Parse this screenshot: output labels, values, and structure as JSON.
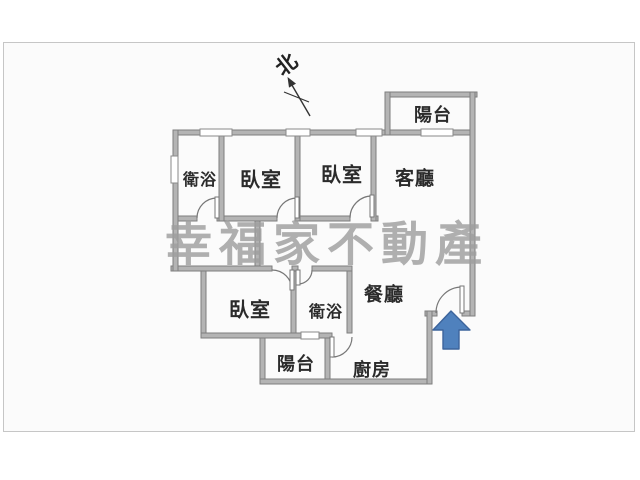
{
  "compass": {
    "label": "北"
  },
  "watermark": {
    "text": "幸福家不動產",
    "color": "#9e9e9e"
  },
  "rooms": [
    {
      "id": "bathroom-top",
      "label": "衛浴"
    },
    {
      "id": "bedroom-top-left",
      "label": "臥室"
    },
    {
      "id": "bedroom-top-middle",
      "label": "臥室"
    },
    {
      "id": "living-room",
      "label": "客廳"
    },
    {
      "id": "balcony-top",
      "label": "陽台"
    },
    {
      "id": "dining-room",
      "label": "餐廳"
    },
    {
      "id": "bedroom-lower",
      "label": "臥室"
    },
    {
      "id": "bathroom-lower",
      "label": "衛浴"
    },
    {
      "id": "balcony-bottom",
      "label": "陽台"
    },
    {
      "id": "kitchen",
      "label": "廚房"
    }
  ],
  "colors": {
    "wall_fill": "#b4b4b4",
    "wall_edge": "#7e7e7e",
    "door_line": "#777777",
    "window_edge": "#8a8a8a",
    "frame_border": "#c6c6c6",
    "canvas_bg": "#fbfbfb",
    "label_color": "#2b2b2b",
    "arrow_fill": "#4f81bd",
    "arrow_edge": "#3c649c",
    "north_color": "#333333"
  }
}
